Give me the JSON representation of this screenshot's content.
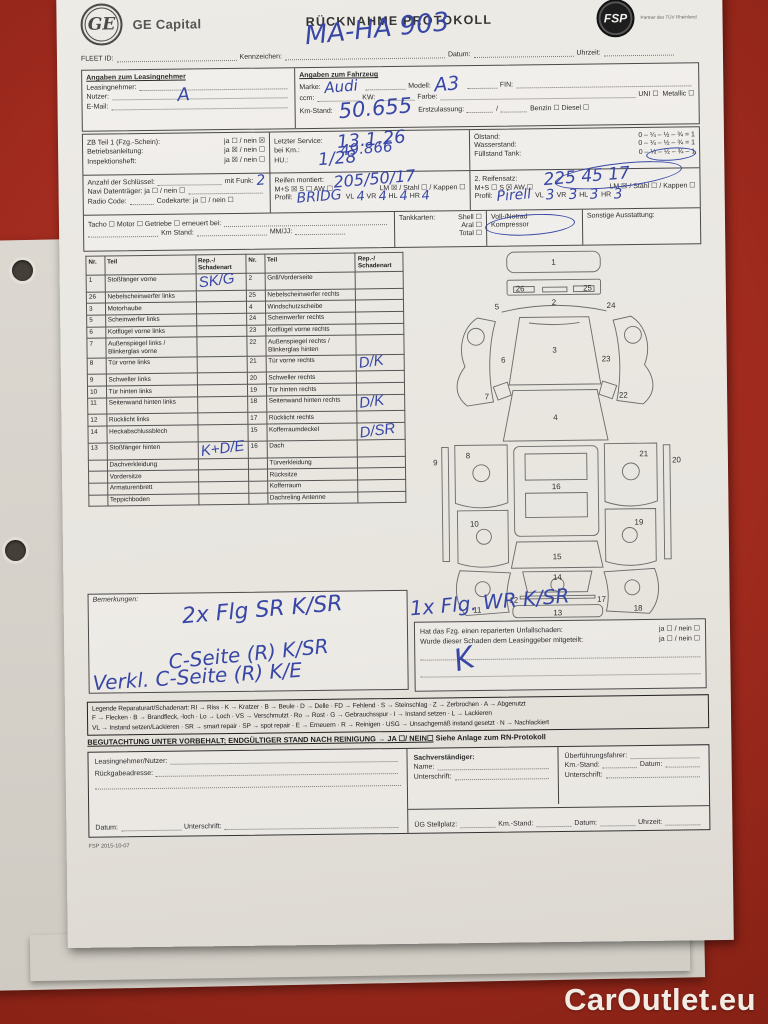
{
  "watermark": "CarOutlet.eu",
  "footer_code": "FSP 2015-10-07",
  "header": {
    "ge_monogram": "GE",
    "brand": "GE Capital",
    "title": "RÜCKNAHME PROTOKOLL",
    "partner": "FSP",
    "partner_tagline": "Partner des TÜV Rheinland"
  },
  "fleet": {
    "fleet_id": "FLEET ID:",
    "kennzeichen": "Kennzeichen:",
    "kennzeichen_value": "MA-HA 903",
    "datum": "Datum:",
    "uhrzeit": "Uhrzeit:"
  },
  "lessee": {
    "title": "Angaben zum Leasingnehmer",
    "leasingnehmer": "Leasingnehmer:",
    "nutzer": "Nutzer:",
    "nutzer_value": "A",
    "email": "E-Mail:"
  },
  "vehicle": {
    "title": "Angaben zum Fahrzeug",
    "marke": "Marke:",
    "marke_value": "Audi",
    "modell": "Modell:",
    "modell_value": "A3",
    "fin": "FIN:",
    "ccm": "ccm:",
    "kw": "KW:",
    "farbe": "Farbe:",
    "uni": "UNI ☐",
    "metallic": "Metallic ☐",
    "km": "Km-Stand:",
    "km_value": "50.655",
    "erstzulassung": "Erstzulassung:",
    "slash": "/",
    "benzin": "Benzin ☐",
    "diesel": "Diesel ☐"
  },
  "docs": {
    "zb": "ZB Teil 1 (Fzg.-Schein):",
    "zb_opts": "ja ☐ / nein ☒",
    "ba": "Betriebsanleitung:",
    "ba_opts": "ja ☒ / nein ☐",
    "ih": "Inspektionsheft:",
    "ih_opts": "ja ☒ / nein ☐",
    "keys": "Anzahl der Schlüssel:",
    "funk": "mit Funk:",
    "funk_value": "2",
    "navi": "Navi Datenträger:  ja ☐ / nein ☐",
    "radio": "Radio Code:",
    "codekarte": "Codekarte:  ja ☐ / nein ☐",
    "tacho_line": "Tacho ☐   Motor ☐   Getriebe ☐   erneuert bei:",
    "km_stand": "Km Stand:",
    "mmjj": "MM/JJ:"
  },
  "service": {
    "letzter": "Letzter Service:",
    "letzter_value": "13.1.26",
    "bei_km": "bei Km.:",
    "bei_km_value": "49.866",
    "hu": "HU.:",
    "hu_value": "1/28"
  },
  "levels": {
    "oel": "Ölstand:",
    "oel_scale": "0 – ¼ – ½ – ¾ = 1",
    "wasser": "Wasserstand:",
    "wasser_scale": "0 – ¼ – ½ – ¾ = 1",
    "tank": "Füllstand Tank:",
    "tank_scale": "0 – ¼ – ½ – ¾ – 1"
  },
  "tires": {
    "mounted": "Reifen montiert:",
    "mounted_value": "205/50/17",
    "set1_types": "M+S ☒  S ☐  AW ☐",
    "set1_rims": "LM ☒ / Stahl ☐ / Kappen ☐",
    "profil": "Profil:",
    "set1_brand": "BRIDG",
    "vl": "VL",
    "vr": "VR",
    "hl": "HL",
    "hr": "HR",
    "set1_depths": [
      "4",
      "4",
      "4",
      "4"
    ],
    "set2": "2. Reifensatz:",
    "set2_value": "225 45 17",
    "set2_types": "M+S ☐  S ☒  AW ☐",
    "set2_rims": "LM ☒ / Stahl ☐ / Kappen ☐",
    "set2_brand": "Pirell",
    "set2_depths": [
      "3",
      "3",
      "3",
      "3"
    ]
  },
  "extras": {
    "tankkarten": "Tankkarten:",
    "cards": [
      "Shell ☐",
      "Aral ☐",
      "Total ☐"
    ],
    "notrad_1": "Voll-/Notrad",
    "notrad_2": "Kompressor",
    "sonstige": "Sonstige Ausstattung:"
  },
  "parts_table": {
    "headers": [
      "Nr.",
      "Teil",
      "Rep.-/ Schadenart",
      "Nr.",
      "Teil",
      "Rep.-/ Schadenart"
    ],
    "rows": [
      [
        "1",
        "Stoßfänger vorne",
        "SK/G",
        "2",
        "Grill/Vorderseite",
        ""
      ],
      [
        "26",
        "Nebelscheinwerfer links",
        "",
        "25",
        "Nebelscheinwerfer rechts",
        ""
      ],
      [
        "3",
        "Motorhaube",
        "",
        "4",
        "Windschutzscheibe",
        ""
      ],
      [
        "5",
        "Scheinwerfer links",
        "",
        "24",
        "Scheinwerfer rechts",
        ""
      ],
      [
        "6",
        "Kotflügel vorne links",
        "",
        "23",
        "Kotflügel vorne rechts",
        ""
      ],
      [
        "7",
        "Außenspiegel links / Blinkerglas vorne",
        "",
        "22",
        "Außenspiegel rechts / Blinkerglas hinten",
        ""
      ],
      [
        "8",
        "Tür vorne links",
        "",
        "21",
        "Tür vorne rechts",
        "D/K"
      ],
      [
        "9",
        "Schweller links",
        "",
        "20",
        "Schweller rechts",
        ""
      ],
      [
        "10",
        "Tür hinten links",
        "",
        "19",
        "Tür hinten rechts",
        ""
      ],
      [
        "11",
        "Seitenwand hinten links",
        "",
        "18",
        "Seitenwand hinten rechts",
        "D/K"
      ],
      [
        "12",
        "Rücklicht links",
        "",
        "17",
        "Rücklicht rechts",
        ""
      ],
      [
        "14",
        "Heckabschlussblech",
        "",
        "15",
        "Kofferraumdeckel",
        "D/SR"
      ],
      [
        "13",
        "Stoßfänger hinten",
        "K+D/E",
        "16",
        "Dach",
        ""
      ],
      [
        "",
        "Dachverkleidung",
        "",
        "",
        "Türverkleidung",
        ""
      ],
      [
        "",
        "Vordersitze",
        "",
        "",
        "Rücksitze",
        ""
      ],
      [
        "",
        "Armaturenbrett",
        "",
        "",
        "Kofferraum",
        ""
      ],
      [
        "",
        "Teppichboden",
        "",
        "",
        "Dachreling Antenne",
        ""
      ]
    ]
  },
  "bemerkungen": {
    "label": "Bemerkungen:"
  },
  "questions": {
    "q1": "Hat das Fzg. einen reparierten Unfallschaden:",
    "q1_opts": "ja ☐ / nein ☐",
    "q2": "Wurde dieser Schaden dem Leasinggeber mitgeteilt:",
    "q2_opts": "ja ☐ / nein ☐"
  },
  "legend": {
    "lines": [
      "Legende Reparaturart/Schadenart: RI → Riss · K → Kratzer · B → Beule · D → Delle · FD → Fehlend · S → Steinschlag · Z → Zerbrochen · A → Abgenutzt",
      "F → Flecken · B → Brandfleck, -loch · Lo → Loch · VS → Verschmutzt · Ro → Rost · G → Gebrauchsspur · I → Instand setzen · L → Lackieren",
      "VL → Instand setzen/Lackieren · SR → smart repair · SP → spot repair · E → Erneuern · R → Reinigen · USG → Unsachgemäß instand gesetzt · N → Nachlackiert"
    ]
  },
  "assessment": {
    "text": "BEGUTACHTUNG UNTER VORBEHALT; ENDGÜLTIGER STAND NACH REINIGUNG → JA ☐/ NEIN☐",
    "suffix": " Siehe Anlage zum RN-Protokoll"
  },
  "signatures": {
    "ln": "Leasingnehmer/Nutzer:",
    "addr": "Rückgabeadresse:",
    "datum": "Datum:",
    "unterschrift": "Unterschrift:",
    "sv_title": "Sachverständiger:",
    "sv_name": "Name:",
    "sv_unterschrift": "Unterschrift:",
    "uf": "Überführungsfahrer:",
    "uf_km": "Km.-Stand:",
    "uf_datum": "Datum:",
    "uf_unterschrift": "Unterschrift:",
    "ug": "ÜG Stellplatz:",
    "ug_km": "Km.-Stand:",
    "ug_datum": "Datum:",
    "ug_uhrzeit": "Uhrzeit:"
  },
  "handwriting": {
    "items": [
      {
        "text": "MA-HA 903",
        "x": 248,
        "y": 24,
        "size": 26,
        "rot": -5
      },
      {
        "text": "2x Flg SR  K/SR",
        "x": 118,
        "y": 606,
        "size": 22,
        "rot": -4
      },
      {
        "text": "C-Seite (R) K/SR",
        "x": 104,
        "y": 650,
        "size": 20,
        "rot": -5
      },
      {
        "text": "Verkl. C-Seite (R) K/E",
        "x": 28,
        "y": 672,
        "size": 20,
        "rot": -3
      },
      {
        "text": "1x Flg. WR  K/SR",
        "x": 346,
        "y": 601,
        "size": 20,
        "rot": -4
      },
      {
        "text": "K",
        "x": 390,
        "y": 654,
        "size": 30,
        "rot": -14
      }
    ],
    "circles": [
      {
        "x": 588,
        "y": 159,
        "w": 50,
        "h": 13,
        "rot": -3
      },
      {
        "x": 496,
        "y": 174,
        "w": 128,
        "h": 24,
        "rot": -6
      },
      {
        "x": 426,
        "y": 224,
        "w": 90,
        "h": 21,
        "rot": -3
      }
    ]
  },
  "diagram": {
    "labels": [
      {
        "n": "1",
        "x": 140,
        "y": 20
      },
      {
        "n": "26",
        "x": 104,
        "y": 48
      },
      {
        "n": "25",
        "x": 176,
        "y": 48
      },
      {
        "n": "2",
        "x": 140,
        "y": 63
      },
      {
        "n": "5",
        "x": 79,
        "y": 67
      },
      {
        "n": "24",
        "x": 201,
        "y": 67
      },
      {
        "n": "3",
        "x": 140,
        "y": 114
      },
      {
        "n": "6",
        "x": 85,
        "y": 124
      },
      {
        "n": "23",
        "x": 195,
        "y": 124
      },
      {
        "n": "7",
        "x": 67,
        "y": 163
      },
      {
        "n": "22",
        "x": 213,
        "y": 163
      },
      {
        "n": "4",
        "x": 140,
        "y": 186
      },
      {
        "n": "8",
        "x": 46,
        "y": 226
      },
      {
        "n": "21",
        "x": 234,
        "y": 226
      },
      {
        "n": "9",
        "x": 11,
        "y": 233
      },
      {
        "n": "20",
        "x": 269,
        "y": 233
      },
      {
        "n": "10",
        "x": 52,
        "y": 299
      },
      {
        "n": "19",
        "x": 228,
        "y": 299
      },
      {
        "n": "16",
        "x": 140,
        "y": 260
      },
      {
        "n": "15",
        "x": 140,
        "y": 335
      },
      {
        "n": "11",
        "x": 54,
        "y": 391
      },
      {
        "n": "18",
        "x": 226,
        "y": 391
      },
      {
        "n": "14",
        "x": 140,
        "y": 357
      },
      {
        "n": "12",
        "x": 93,
        "y": 381
      },
      {
        "n": "17",
        "x": 187,
        "y": 381
      },
      {
        "n": "13",
        "x": 140,
        "y": 395
      }
    ]
  }
}
